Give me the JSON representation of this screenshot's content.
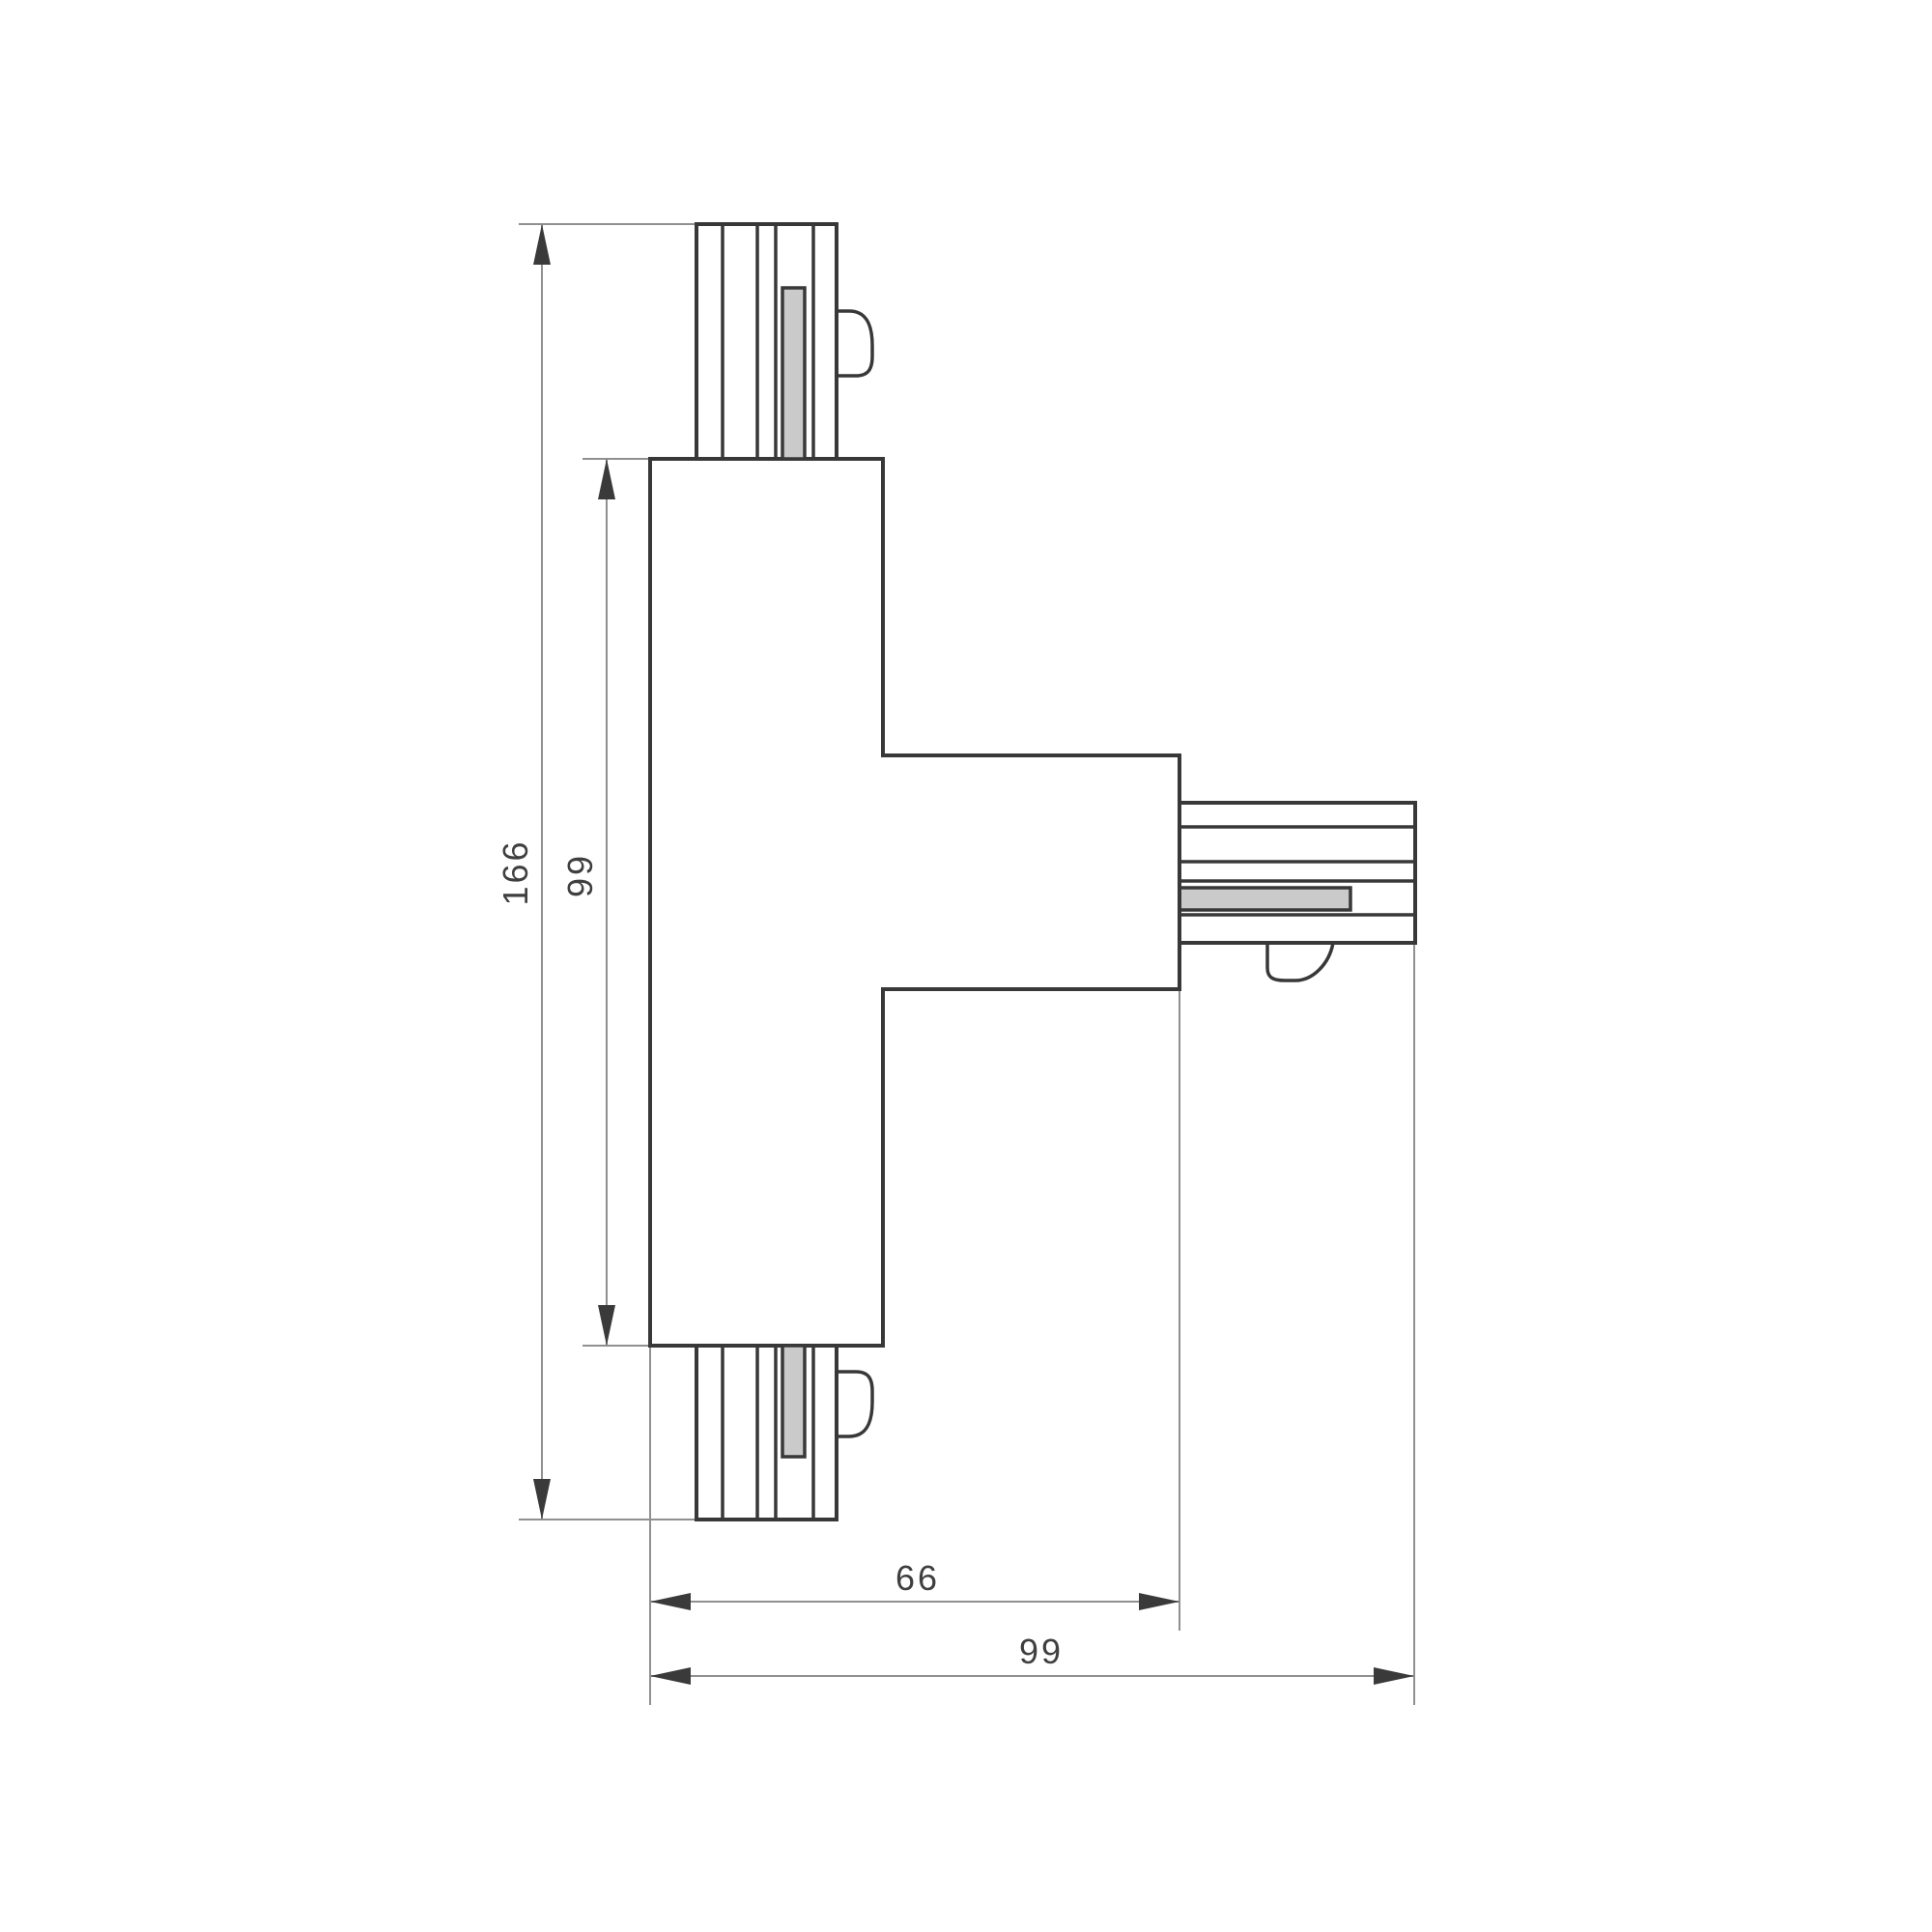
{
  "drawing": {
    "type": "technical-dimension-drawing",
    "dimensions": {
      "total_height": "166",
      "body_height": "99",
      "arm_width": "66",
      "total_width": "99"
    },
    "colors": {
      "outline": "#383838",
      "thin_line": "#909090",
      "arrow": "#3a3a3a",
      "contact_bar_fill": "#cacaca",
      "background": "#ffffff"
    }
  }
}
